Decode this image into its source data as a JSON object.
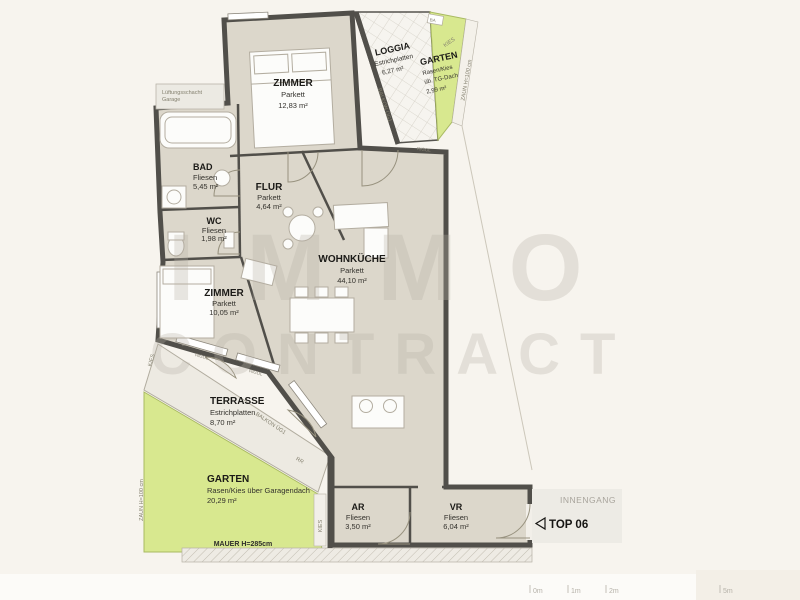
{
  "watermark": {
    "line1": "IMMO",
    "line2": "CONTRACT"
  },
  "rooms": {
    "zimmer1": {
      "name": "ZIMMER",
      "floor": "Parkett",
      "area": "12,83 m²"
    },
    "loggia": {
      "name": "LOGGIA",
      "floor": "Estrichplatten",
      "area": "6,27 m²"
    },
    "garten_top": {
      "name": "GARTEN",
      "floor": "Rasen/Kies",
      "floor2": "üb. TG-Dach",
      "area": "2,99 m²"
    },
    "bad": {
      "name": "BAD",
      "floor": "Fliesen",
      "area": "5,45 m²"
    },
    "flur": {
      "name": "FLUR",
      "floor": "Parkett",
      "area": "4,64 m²"
    },
    "wc": {
      "name": "WC",
      "floor": "Fliesen",
      "area": "1,98 m²"
    },
    "wohnkueche": {
      "name": "WOHNKÜCHE",
      "floor": "Parkett",
      "area": "44,10 m²"
    },
    "zimmer2": {
      "name": "ZIMMER",
      "floor": "Parkett",
      "area": "10,05 m²"
    },
    "terrasse": {
      "name": "TERRASSE",
      "floor": "Estrichplatten",
      "area": "8,70 m²"
    },
    "garten": {
      "name": "GARTEN",
      "floor": "Rasen/Kies über Garagendach",
      "area": "20,29 m²"
    },
    "ar": {
      "name": "AR",
      "floor": "Fliesen",
      "area": "3,50 m²"
    },
    "vr": {
      "name": "VR",
      "floor": "Fliesen",
      "area": "6,04 m²"
    }
  },
  "annotations": {
    "innengang": "INNENGANG",
    "top_unit": "TOP 06",
    "mauer": "MAUER H=285cm",
    "zaun_left": "ZAUN H=100 cm",
    "zaun_right": "ZAUN H=100 cm",
    "kies_top": "KIES",
    "kies_left": "KIES",
    "kies_bottom": "KIES",
    "shaft_line1": "Lüftungsschacht",
    "shaft_line2": "Garage",
    "balkon_top": "BALKON ÜG1",
    "balkon_bottom": "BALKON ÜG1",
    "rigol_top": "RIGOL",
    "rigol_mid": "RIGOL",
    "rigol_bottom": "RIGOL",
    "rr": "RR",
    "ba": "BA"
  },
  "scalebar": {
    "ticks": [
      "0m",
      "1m",
      "2m",
      "5m"
    ]
  },
  "palette": {
    "background": "#f7f4ee",
    "room_fill": "#dcd7cb",
    "wall": "#514f4a",
    "garden_green": "#d8e88f",
    "terrace_fill": "#edeae2",
    "watermark": "#b7b1a4"
  }
}
